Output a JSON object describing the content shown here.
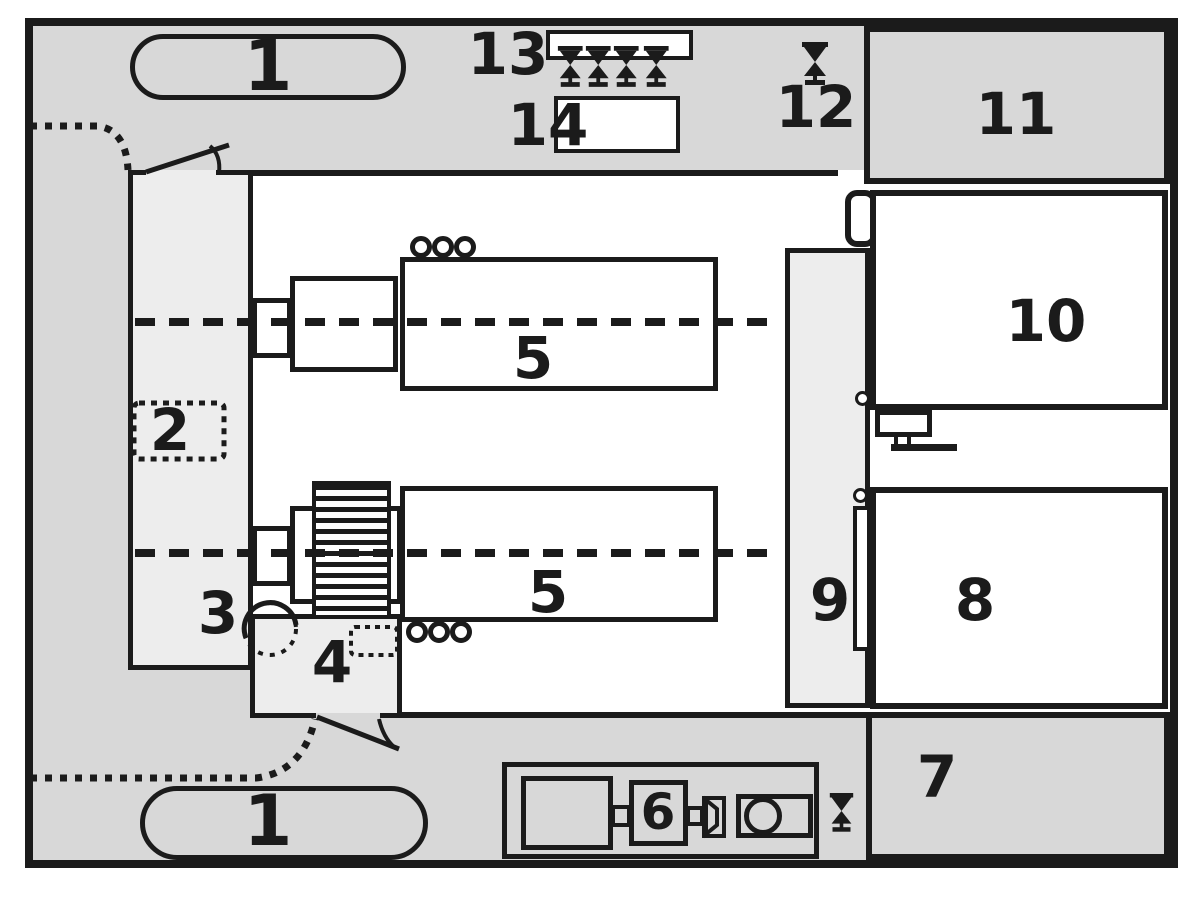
{
  "diagram": {
    "labels": {
      "zone1_top": "1",
      "zone1_bottom": "1",
      "zone2": "2",
      "zone3": "3",
      "zone4": "4",
      "zone5_upper": "5",
      "zone5_lower": "5",
      "zone6": "6",
      "zone7": "7",
      "zone8": "8",
      "zone9": "9",
      "zone10": "10",
      "zone11": "11",
      "zone12": "12",
      "zone13": "13",
      "zone14": "14"
    },
    "icons": {
      "valve": "bowtie-valve-symbol",
      "door": "door-swing-arc",
      "route": "dotted-path",
      "centerline": "dashed-axis-line"
    },
    "colors": {
      "band": "#d8d8d8",
      "room": "#ededed",
      "hall": "#ffffff",
      "line": "#1b1b1b",
      "page": "#ffffff"
    }
  }
}
